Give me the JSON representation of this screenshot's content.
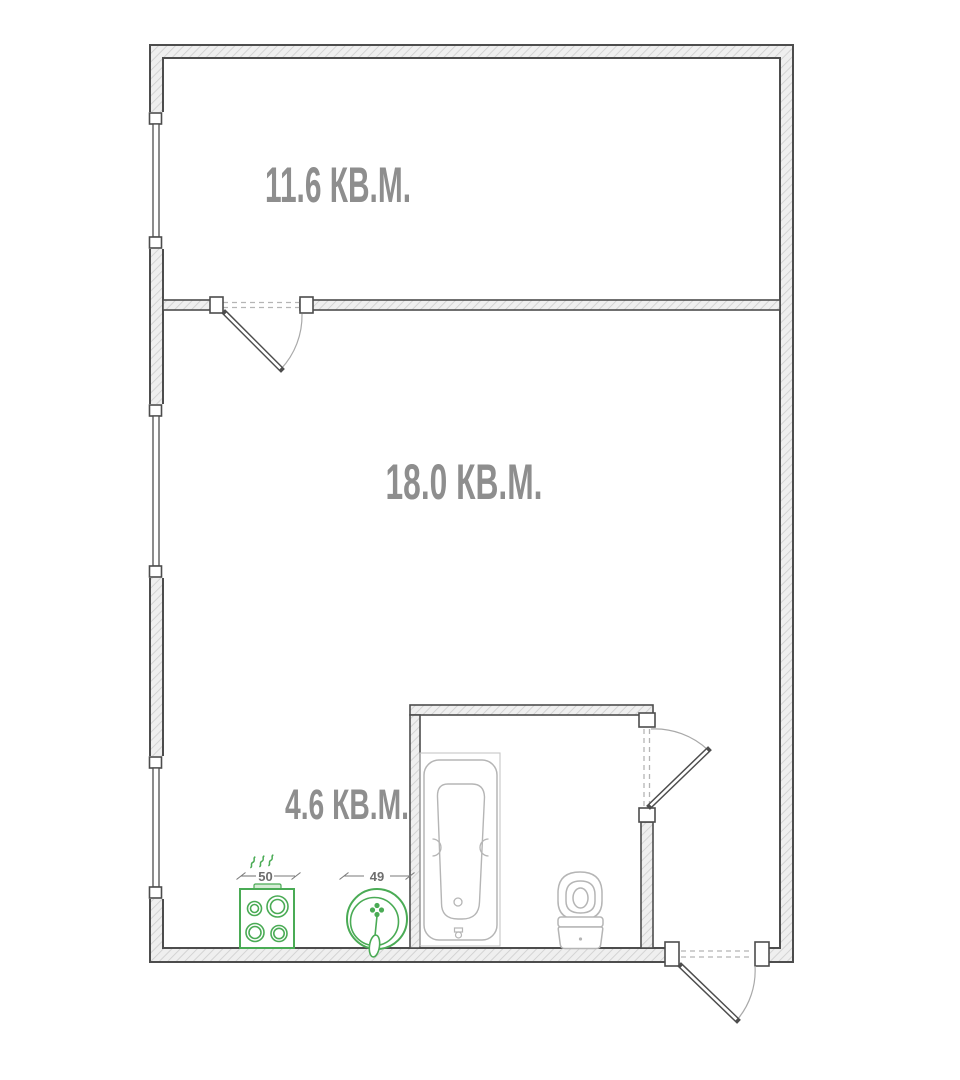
{
  "plan_title": "Apartment floor plan",
  "rooms": [
    {
      "id": "bedroom",
      "label": "11.6 КВ.М."
    },
    {
      "id": "living",
      "label": "18.0 КВ.М."
    },
    {
      "id": "kitchen",
      "label": "4.6 КВ.М."
    }
  ],
  "dimensions": {
    "stove_width": "50",
    "sink_width": "49"
  },
  "icons": {
    "stove": "stove-icon",
    "sink": "sink-icon",
    "bathtub": "bathtub-icon",
    "toilet": "toilet-icon",
    "window": "window-icon",
    "door": "door-swing-icon"
  },
  "colors": {
    "wall_outline": "#4d4d4d",
    "wall_hatch": "#cdcdcd",
    "wall_fill": "#efefef",
    "label_gray": "#8e8e8e",
    "dim_gray": "#6e6e6e",
    "dim_line": "#7a7a7a",
    "fixture_gray": "#b5b5b5",
    "fixture_light": "#c6c6c6",
    "green": "#4aab55",
    "green_light": "#d6ecd6"
  }
}
